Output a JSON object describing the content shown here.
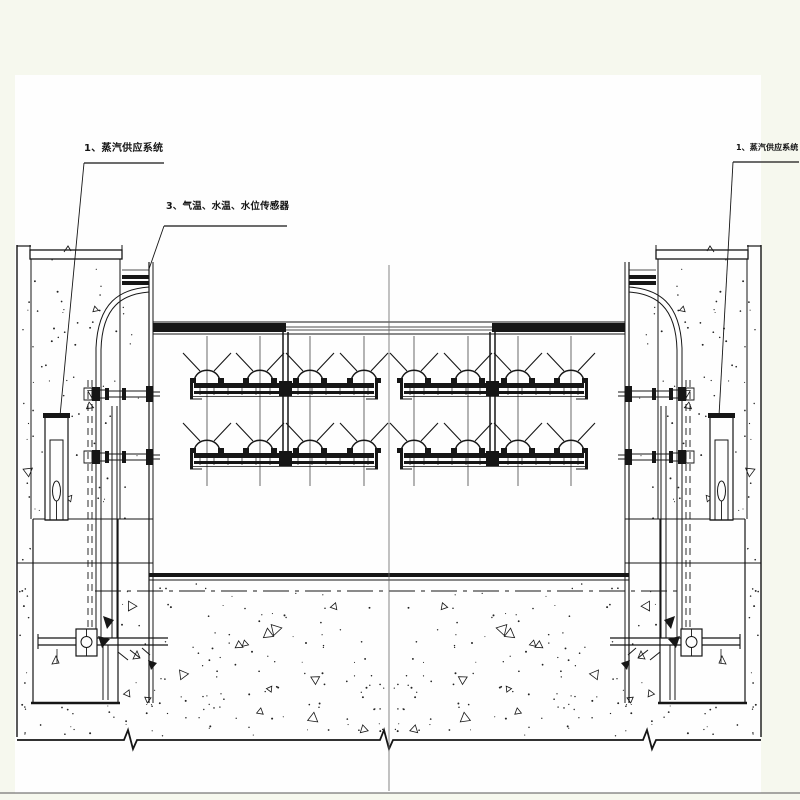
{
  "drawing": {
    "kind": "engineering-section-drawing",
    "labels": {
      "steam_left": "1、蒸汽供应系统",
      "sensors": "3、气温、水温、水位传感器",
      "steam_right": "1、蒸汽供应系统"
    },
    "colors": {
      "ink": "#161616",
      "paper": "#fefefe",
      "margin": "#f6f8ee",
      "centerline": "#666666"
    }
  }
}
